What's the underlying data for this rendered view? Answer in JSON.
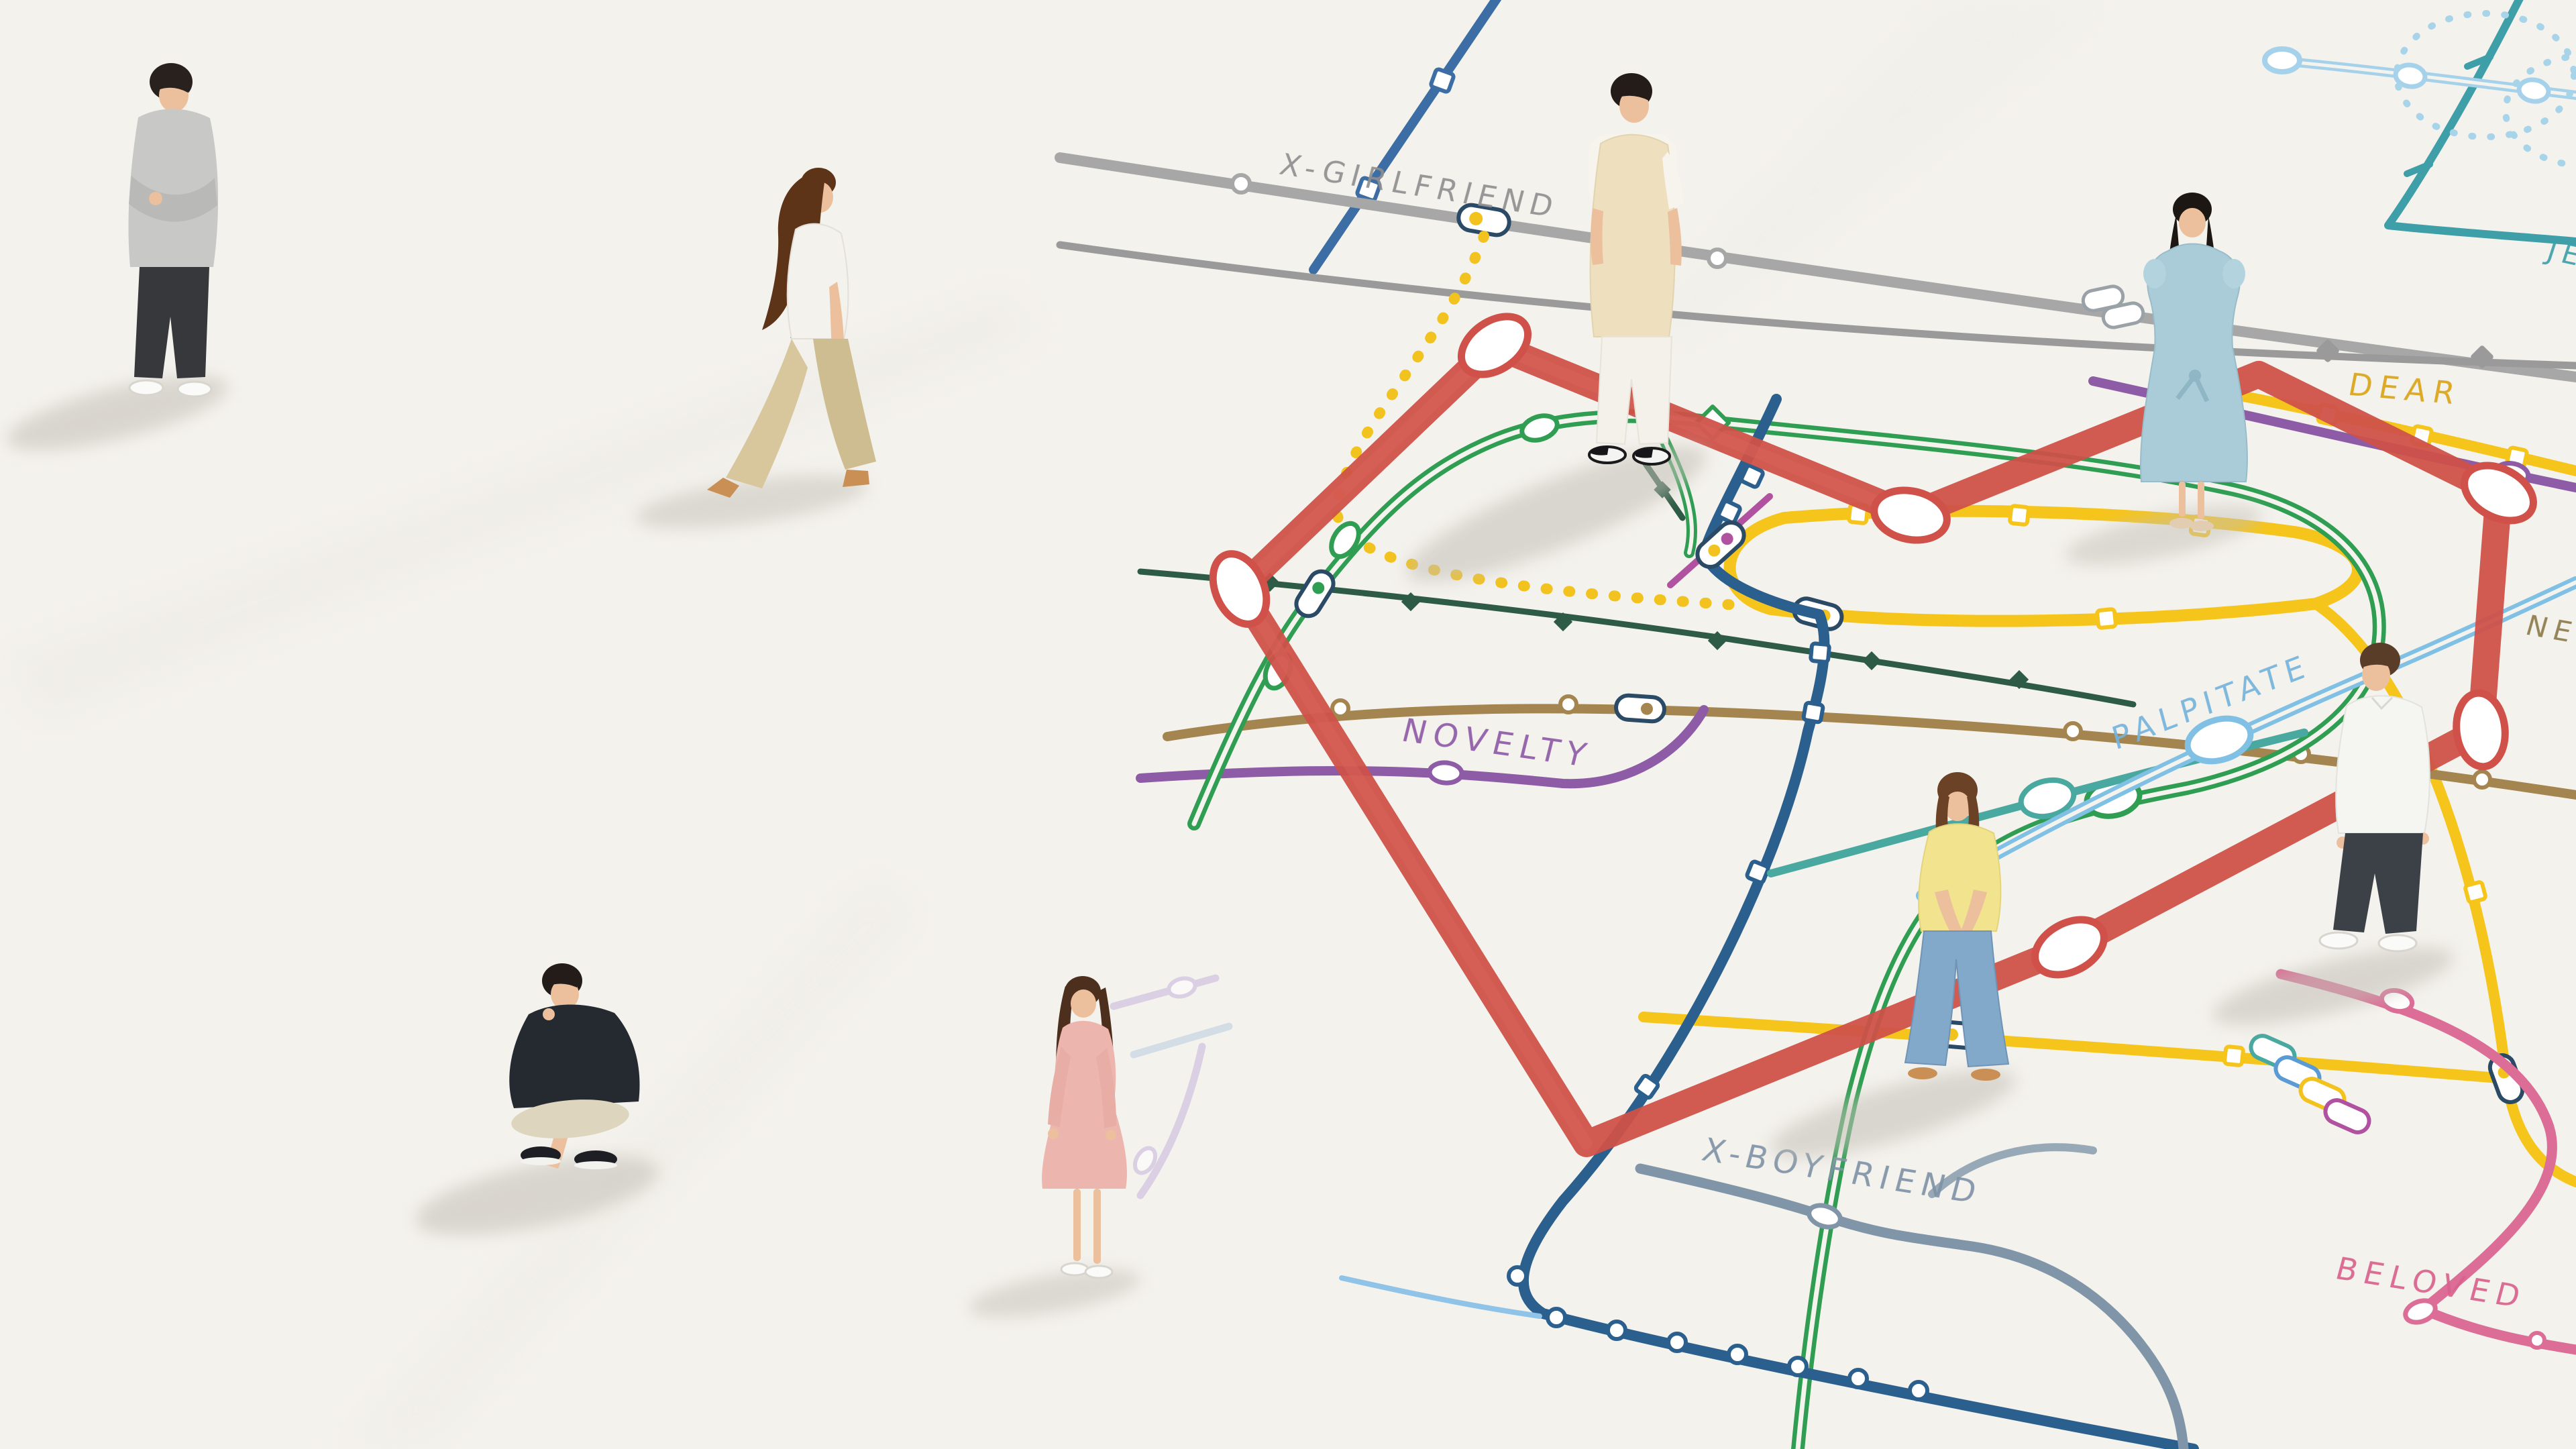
{
  "poster": {
    "background_color": "#f5f3ee",
    "style": "isometric subway-map poster with a heart-shaped red line and eight standing figures"
  },
  "map": {
    "heart_line_color": "#cf5149",
    "labels": [
      {
        "id": "x-girlfriend",
        "text": "X-GIRLFRIEND",
        "color": "#8f8f8f"
      },
      {
        "id": "dear",
        "text": "DEAR",
        "color": "#d9a416"
      },
      {
        "id": "jealousy-partial",
        "text": "JE",
        "color": "#3f9fa8"
      },
      {
        "id": "ne-partial",
        "text": "NE",
        "color": "#8d7b4a"
      },
      {
        "id": "novelty",
        "text": "NOVELTY",
        "color": "#8e5ba6"
      },
      {
        "id": "palpitate",
        "text": "PALPITATE",
        "color": "#74b4dc"
      },
      {
        "id": "x-boyfriend",
        "text": "X-BOYFRIEND",
        "color": "#7f93a6"
      },
      {
        "id": "beloved",
        "text": "BELOVED",
        "color": "#d9608c"
      },
      {
        "id": "n-partial",
        "text": "N",
        "color": "#3aa655"
      }
    ],
    "lines": [
      {
        "name": "heart",
        "color": "#cf5149"
      },
      {
        "name": "x-girlfriend-gray",
        "color": "#a0a0a0"
      },
      {
        "name": "dear-yellow",
        "color": "#f6c51b"
      },
      {
        "name": "yellow-dotted",
        "color": "#f2c21e"
      },
      {
        "name": "novelty-purple",
        "color": "#8e5ba6"
      },
      {
        "name": "palpitate-light-blue",
        "color": "#7fc0e4"
      },
      {
        "name": "x-boyfriend-slate",
        "color": "#8096a8"
      },
      {
        "name": "beloved-pink",
        "color": "#db6d96"
      },
      {
        "name": "jealousy-teal",
        "color": "#3f9fa8"
      },
      {
        "name": "green-double",
        "color": "#2f9e53"
      },
      {
        "name": "dark-green",
        "color": "#2d5b45"
      },
      {
        "name": "navy",
        "color": "#2b5f8e"
      },
      {
        "name": "olive-brown",
        "color": "#a5854f"
      },
      {
        "name": "magenta",
        "color": "#b052a0"
      },
      {
        "name": "lavender",
        "color": "#c9b8dd"
      },
      {
        "name": "light-blue-double-top",
        "color": "#a5d2ea"
      }
    ]
  },
  "people": [
    {
      "id": "man-arms-crossed",
      "pose": "standing with arms crossed",
      "outfit": "gray sweatshirt, dark pants, white shoes",
      "hair": "black"
    },
    {
      "id": "woman-walking",
      "pose": "walking in left profile",
      "outfit": "white blouse, beige wide-leg trousers, tan heels",
      "hair": "long brown"
    },
    {
      "id": "man-crouching",
      "pose": "crouching with hand at chin",
      "outfit": "dark navy sweater, cream trousers, black sneakers",
      "hair": "black"
    },
    {
      "id": "woman-pink-dress",
      "pose": "standing",
      "outfit": "pink wrap dress, white flats",
      "hair": "long brown"
    },
    {
      "id": "man-cream-vest",
      "pose": "standing, hands in pockets",
      "outfit": "cream knit vest over white tee, white trousers, b/w sneakers",
      "hair": "black"
    },
    {
      "id": "woman-blue-dress",
      "pose": "standing, hands behind back",
      "outfit": "light blue midi dress with waist tie, beige sandals",
      "hair": "long black"
    },
    {
      "id": "woman-yellow-top",
      "pose": "standing, hands clasped in front",
      "outfit": "yellow top, flared blue jeans, tan sandals",
      "hair": "brown bob"
    },
    {
      "id": "man-white-shirt",
      "pose": "standing, looking aside",
      "outfit": "white shirt, charcoal trousers, white shoes",
      "hair": "brown"
    }
  ]
}
